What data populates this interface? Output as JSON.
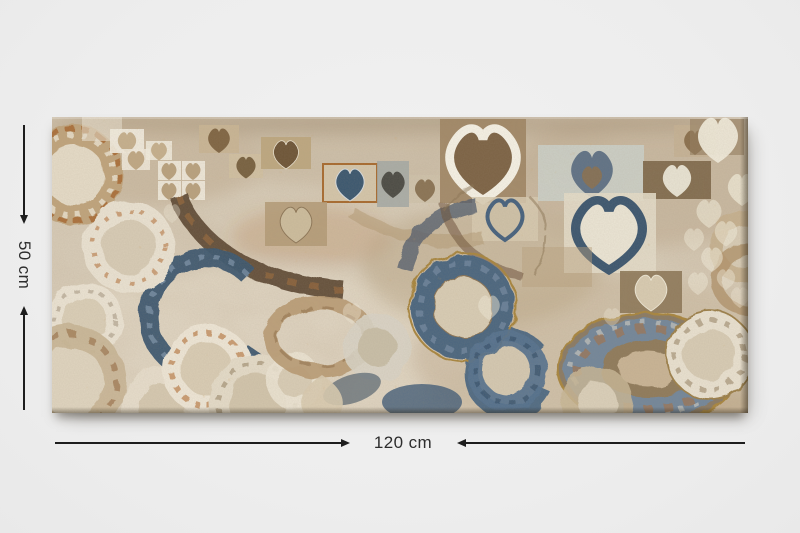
{
  "product_image": {
    "type": "canvas wall art print",
    "description": "Abstract collage artwork on a textured beige canvas: white and tan squares holding heart and teardrop motifs, sweeping dark-brown and navy arcs, and mottled rings and plates in cream, rust and blue",
    "background_color": "#ededed",
    "palette": {
      "canvas_beige": "#d8ccb8",
      "tan": "#b59a74",
      "dark_brown": "#5a4532",
      "rust_orange": "#b06a2f",
      "cream_white": "#f2ede0",
      "navy_blue": "#3a556f",
      "steel_blue": "#5e7186",
      "gold_rim": "#a8853e"
    }
  },
  "dimensions": {
    "height": {
      "label": "50 cm",
      "value": 50,
      "unit": "cm"
    },
    "width": {
      "label": "120 cm",
      "value": 120,
      "unit": "cm"
    }
  },
  "annotation_style": {
    "line_color": "#1d1d1d",
    "text_color": "#2d2d2d",
    "arrow_direction": "arrowheads point inward toward the measurement label"
  }
}
